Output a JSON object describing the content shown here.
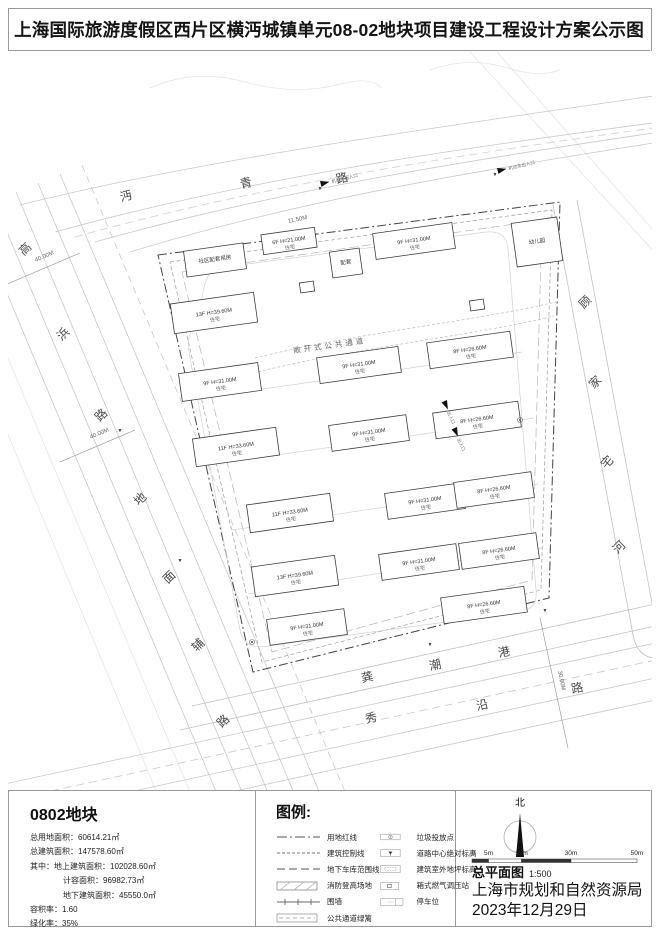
{
  "title": "上海国际旅游度假区西片区横沔城镇单元08-02地块项目建设工程设计方案公示图",
  "parcel_info": {
    "title": "0802地块",
    "rows": [
      {
        "label": "总用地面积",
        "value": "60614.21㎡",
        "indent": 0
      },
      {
        "label": "总建筑面积",
        "value": "147578.60㎡",
        "indent": 0
      },
      {
        "label": "其中：地上建筑面积",
        "value": "102028.60㎡",
        "indent": 0
      },
      {
        "label": "计容面积",
        "value": "96982.73㎡",
        "indent": 1
      },
      {
        "label": "地下建筑面积",
        "value": "45550.0㎡",
        "indent": 1
      },
      {
        "label": "容积率",
        "value": "1.60",
        "indent": 0
      },
      {
        "label": "绿化率",
        "value": "35%",
        "indent": 0
      }
    ]
  },
  "legend": {
    "title": "图例:",
    "left": [
      {
        "sym": "dashdot",
        "label": "用地红线"
      },
      {
        "sym": "dashed-fine",
        "label": "建筑控制线"
      },
      {
        "sym": "dashed-long",
        "label": "地下车库范围线"
      },
      {
        "sym": "fire-pad",
        "label": "消防登高场地"
      },
      {
        "sym": "fence",
        "label": "围墙"
      },
      {
        "sym": "hedge",
        "label": "公共通道绿篱"
      }
    ],
    "right": [
      {
        "sym": "trash",
        "label": "垃圾投放点"
      },
      {
        "sym": "road-elev",
        "label": "道路中心绝对标高"
      },
      {
        "sym": "bldg-elev",
        "label": "建筑室外地坪标高"
      },
      {
        "sym": "gas",
        "label": "箱式燃气调压站"
      },
      {
        "sym": "parking",
        "label": "停车位"
      }
    ]
  },
  "title_block": {
    "north_label": "北",
    "scale_ticks": [
      "0",
      "5m",
      "15m",
      "30m",
      "50m"
    ],
    "drawing_name": "总平面图",
    "scale": "1:500",
    "agency": "上海市规划和自然资源局",
    "date": "2023年12月29日"
  },
  "site_plan": {
    "passage_label": "敞开式公共通道",
    "roads": [
      {
        "name": "沔青路",
        "rot": -14,
        "pos": [
          [
            127,
            200
          ],
          [
            247,
            187
          ],
          [
            343,
            182
          ]
        ]
      },
      {
        "name": "高浜路",
        "rot": -44,
        "pos": [
          [
            28,
            252
          ],
          [
            66,
            337
          ],
          [
            104,
            418
          ]
        ]
      },
      {
        "name": "地面辅路",
        "rot": -44,
        "pos": [
          [
            143,
            502
          ],
          [
            172,
            580
          ],
          [
            201,
            648
          ],
          [
            226,
            724
          ]
        ]
      },
      {
        "name": "秀沿路",
        "rot": -12,
        "pos": [
          [
            372,
            722
          ],
          [
            483,
            709
          ],
          [
            578,
            692
          ]
        ]
      },
      {
        "name": "龚潮港",
        "rot": -12,
        "pos": [
          [
            368,
            681
          ],
          [
            436,
            669
          ],
          [
            505,
            656
          ]
        ]
      },
      {
        "name": "顾家宅河",
        "rot": -45,
        "pos": [
          [
            588,
            305
          ],
          [
            598,
            385
          ],
          [
            610,
            465
          ],
          [
            622,
            550
          ]
        ]
      }
    ],
    "dimensions": [
      {
        "text": "40.00M",
        "x": 45,
        "y": 258,
        "rot": -23
      },
      {
        "text": "40.00M",
        "x": 100,
        "y": 435,
        "rot": -23
      },
      {
        "text": "30.00M",
        "x": 560,
        "y": 681,
        "rot": 78
      },
      {
        "text": "11.50M",
        "x": 298,
        "y": 221,
        "rot": -12
      }
    ],
    "entrances": [
      {
        "label": "机动车出入口",
        "x": 320,
        "y": 181,
        "rot": -14
      },
      {
        "label": "机动车出入口",
        "x": 497,
        "y": 168,
        "rot": -14
      },
      {
        "label": "出入口",
        "x": 447,
        "y": 400,
        "rot": 66
      },
      {
        "label": "出入口",
        "x": 457,
        "y": 427,
        "rot": 66
      }
    ],
    "elevation_points": [
      [
        320,
        190
      ],
      [
        495,
        176
      ],
      [
        120,
        432
      ],
      [
        180,
        562
      ],
      [
        430,
        646
      ],
      [
        545,
        612
      ]
    ],
    "buildings": [
      {
        "x": 185,
        "y": 247,
        "w": 60,
        "h": 26,
        "label": "社区配套用房",
        "sub": ""
      },
      {
        "x": 262,
        "y": 231,
        "w": 54,
        "h": 20,
        "label": "6F H=21.00M",
        "sub": "住宅"
      },
      {
        "x": 331,
        "y": 250,
        "w": 30,
        "h": 26,
        "label": "配套",
        "sub": ""
      },
      {
        "x": 374,
        "y": 228,
        "w": 80,
        "h": 26,
        "label": "9F H=31.00M",
        "sub": "住宅"
      },
      {
        "x": 514,
        "y": 220,
        "w": 46,
        "h": 44,
        "label": "幼儿园",
        "sub": ""
      },
      {
        "x": 172,
        "y": 298,
        "w": 84,
        "h": 30,
        "label": "13F H=39.60M",
        "sub": "住宅"
      },
      {
        "x": 180,
        "y": 368,
        "w": 80,
        "h": 28,
        "label": "9F H=31.00M",
        "sub": "住宅"
      },
      {
        "x": 318,
        "y": 352,
        "w": 82,
        "h": 26,
        "label": "9F H=31.00M",
        "sub": "住宅"
      },
      {
        "x": 428,
        "y": 337,
        "w": 84,
        "h": 26,
        "label": "8F H=26.60M",
        "sub": "住宅"
      },
      {
        "x": 194,
        "y": 433,
        "w": 84,
        "h": 28,
        "label": "11F H=33.60M",
        "sub": "住宅"
      },
      {
        "x": 330,
        "y": 420,
        "w": 78,
        "h": 26,
        "label": "9F H=31.00M",
        "sub": "住宅"
      },
      {
        "x": 434,
        "y": 407,
        "w": 86,
        "h": 26,
        "label": "8F H=26.60M",
        "sub": "住宅"
      },
      {
        "x": 248,
        "y": 499,
        "w": 84,
        "h": 28,
        "label": "11F H=33.60M",
        "sub": "住宅"
      },
      {
        "x": 386,
        "y": 488,
        "w": 78,
        "h": 26,
        "label": "9F H=31.00M",
        "sub": "住宅"
      },
      {
        "x": 455,
        "y": 477,
        "w": 78,
        "h": 26,
        "label": "8F H=26.60M",
        "sub": "住宅"
      },
      {
        "x": 253,
        "y": 561,
        "w": 84,
        "h": 30,
        "label": "13F H=39.60M",
        "sub": "住宅"
      },
      {
        "x": 380,
        "y": 549,
        "w": 78,
        "h": 26,
        "label": "9F H=31.00M",
        "sub": "住宅"
      },
      {
        "x": 460,
        "y": 538,
        "w": 78,
        "h": 26,
        "label": "8F H=26.60M",
        "sub": "住宅"
      },
      {
        "x": 268,
        "y": 614,
        "w": 78,
        "h": 26,
        "label": "9F H=31.00M",
        "sub": "住宅"
      },
      {
        "x": 442,
        "y": 592,
        "w": 84,
        "h": 26,
        "label": "8F H=26.60M",
        "sub": "住宅"
      },
      {
        "x": 300,
        "y": 282,
        "w": 14,
        "h": 10,
        "label": "",
        "sub": ""
      },
      {
        "x": 470,
        "y": 300,
        "w": 14,
        "h": 10,
        "label": "",
        "sub": ""
      }
    ]
  }
}
